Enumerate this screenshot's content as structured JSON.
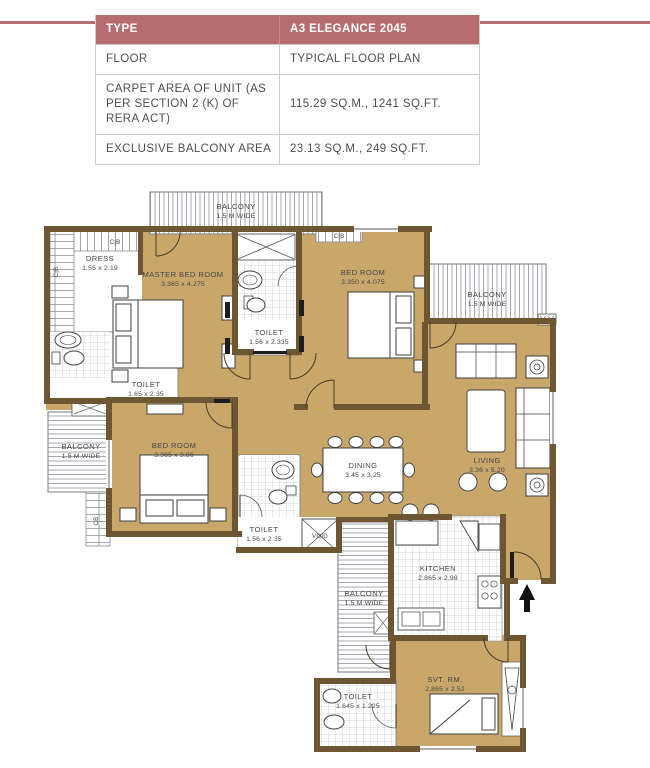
{
  "accent_color": "#b76d70",
  "spec_table": {
    "header": {
      "label": "TYPE",
      "value": "A3 ELEGANCE 2045"
    },
    "rows": [
      {
        "label": "FLOOR",
        "value": "TYPICAL FLOOR PLAN"
      },
      {
        "label": "CARPET AREA OF UNIT (AS PER SECTION 2 (K) OF RERA ACT)",
        "value": "115.29 SQ.M., 1241 SQ.FT."
      },
      {
        "label": "EXCLUSIVE BALCONY AREA",
        "value": "23.13 SQ.M., 249 SQ.FT."
      }
    ]
  },
  "plan": {
    "colors": {
      "floor": "#c9a76a",
      "wall": "#6f5632"
    },
    "rooms": {
      "master": {
        "name": "MASTER BED ROOM",
        "dims": "3.365 x 4.275"
      },
      "bed2": {
        "name": "BED ROOM",
        "dims": "3.350 x 4.075"
      },
      "bed3": {
        "name": "BED ROOM",
        "dims": "3.365 x 3.86"
      },
      "living": {
        "name": "LIVING",
        "dims": "3.36 x 5.20"
      },
      "dining": {
        "name": "DINING",
        "dims": "3.45 x 3.25"
      },
      "kitchen": {
        "name": "KITCHEN",
        "dims": "2.865 x 2.98"
      },
      "servant": {
        "name": "SVT. RM.",
        "dims": "2.865 x 2.52"
      },
      "dress": {
        "name": "DRESS",
        "dims": "1.55 x 2.19"
      },
      "toilet_left": {
        "name": "TOILET",
        "dims": "1.65 x 2.35"
      },
      "toilet_top": {
        "name": "TOILET",
        "dims": "1.56 x 2.335"
      },
      "toilet_mid": {
        "name": "TOILET",
        "dims": "1.56 x 2.35"
      },
      "toilet_bottom": {
        "name": "TOILET",
        "dims": "1.645 x 1.225"
      },
      "balcony_top": {
        "name": "BALCONY",
        "dims": "1.5 M WIDE"
      },
      "balcony_right": {
        "name": "BALCONY",
        "dims": "1.5 M WIDE"
      },
      "balcony_left": {
        "name": "BALCONY",
        "dims": "1.5 M WIDE"
      },
      "balcony_bottom": {
        "name": "BALCONY",
        "dims": "1.5 M WIDE"
      }
    },
    "markers": {
      "cb": "C|B",
      "cb_plain": "CB",
      "void": "VOID"
    }
  }
}
